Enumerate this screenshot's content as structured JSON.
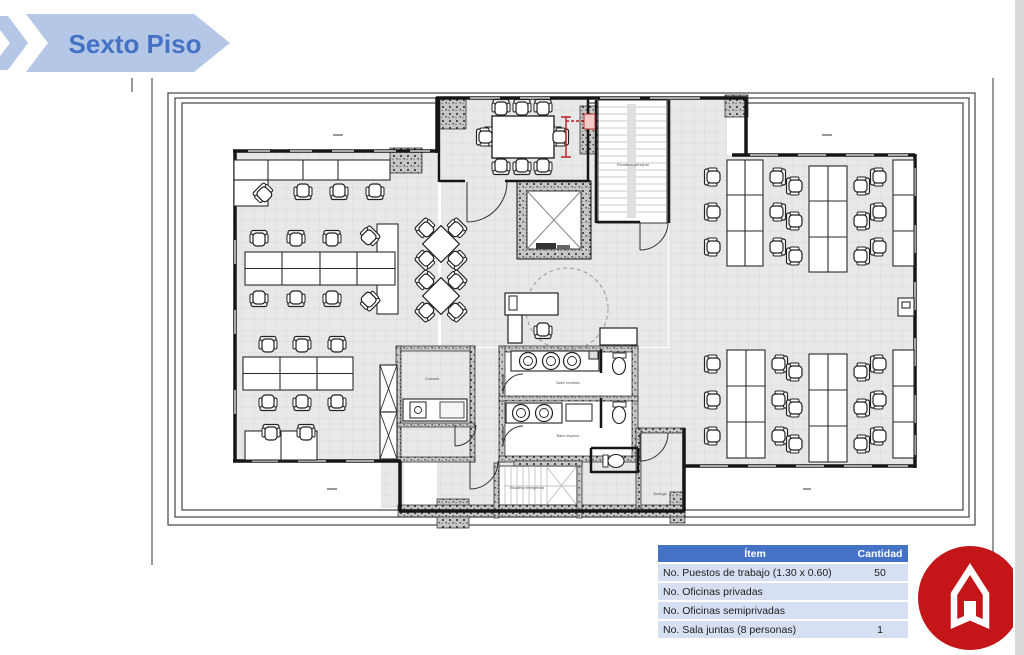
{
  "banner": {
    "title": "Sexto Piso",
    "bg_color": "#b4c7e7",
    "text_color": "#4472c4"
  },
  "floor_plan": {
    "labels": {
      "main_stairs": "Escalera principal",
      "emergency_stairs": "Escalera emergencia",
      "bath_top": "Baño hombres",
      "bath_bottom": "Baño mujeres",
      "kitchenette": "Cocineta",
      "storage": "Bodega"
    },
    "colors": {
      "wall": "#161616",
      "floor": "#e8e8e8",
      "dimension_red": "#b32020"
    }
  },
  "summary_table": {
    "header": {
      "item": "Ítem",
      "qty": "Cantidad"
    },
    "rows": [
      {
        "item": "No. Puestos de trabajo (1.30 x 0.60)",
        "qty": "50"
      },
      {
        "item": "No. Oficinas privadas",
        "qty": ""
      },
      {
        "item": "No. Oficinas semiprivadas",
        "qty": ""
      },
      {
        "item": "No. Sala juntas (8 personas)",
        "qty": "1"
      }
    ],
    "colors": {
      "header_bg": "#4472c4",
      "row_bg": "#d6e0f2"
    }
  },
  "logo": {
    "icon": "home-icon",
    "bg_color": "#c41619"
  }
}
